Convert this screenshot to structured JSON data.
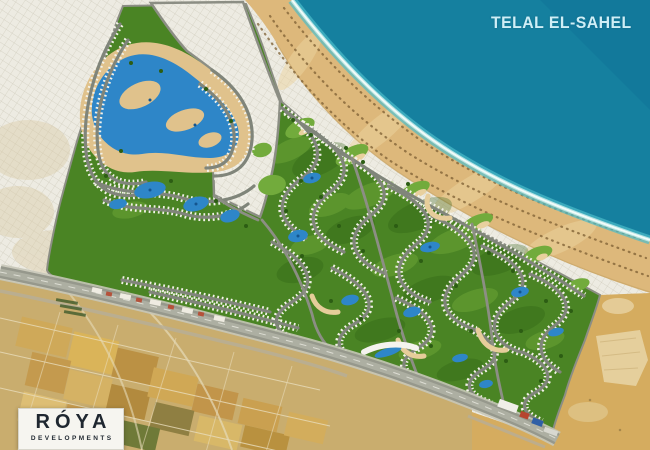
{
  "project": {
    "title": "TELAL EL-SAHEL"
  },
  "logo": {
    "brand": "RÓYA",
    "subtitle": "DEVELOPMENTS"
  },
  "palette": {
    "sea": "#15809f",
    "sea_shallow": "#4cbccb",
    "foam": "#f2fcf9",
    "beach": "#ddb87b",
    "urban": "#edebe2",
    "urban_lines": "#cdc9ba",
    "dev_green": "#4a8424",
    "dev_green_dark": "#2c5d13",
    "dev_green_light": "#72ab3c",
    "lagoon_sand": "#e0c28c",
    "pool_blue": "#2e86c8",
    "pool_deep": "#14558e",
    "row_road": "#80857a",
    "house_white": "#f3f2e9",
    "road": "#8c8e84",
    "highway": "#96988c",
    "fields": "#c9ad6e",
    "desert": "#d5ac5f",
    "umbrella": "#7d5f33",
    "title_text": "#cfeef6",
    "logo_text": "#1f2730",
    "logo_bg": "#f6f5f0"
  }
}
